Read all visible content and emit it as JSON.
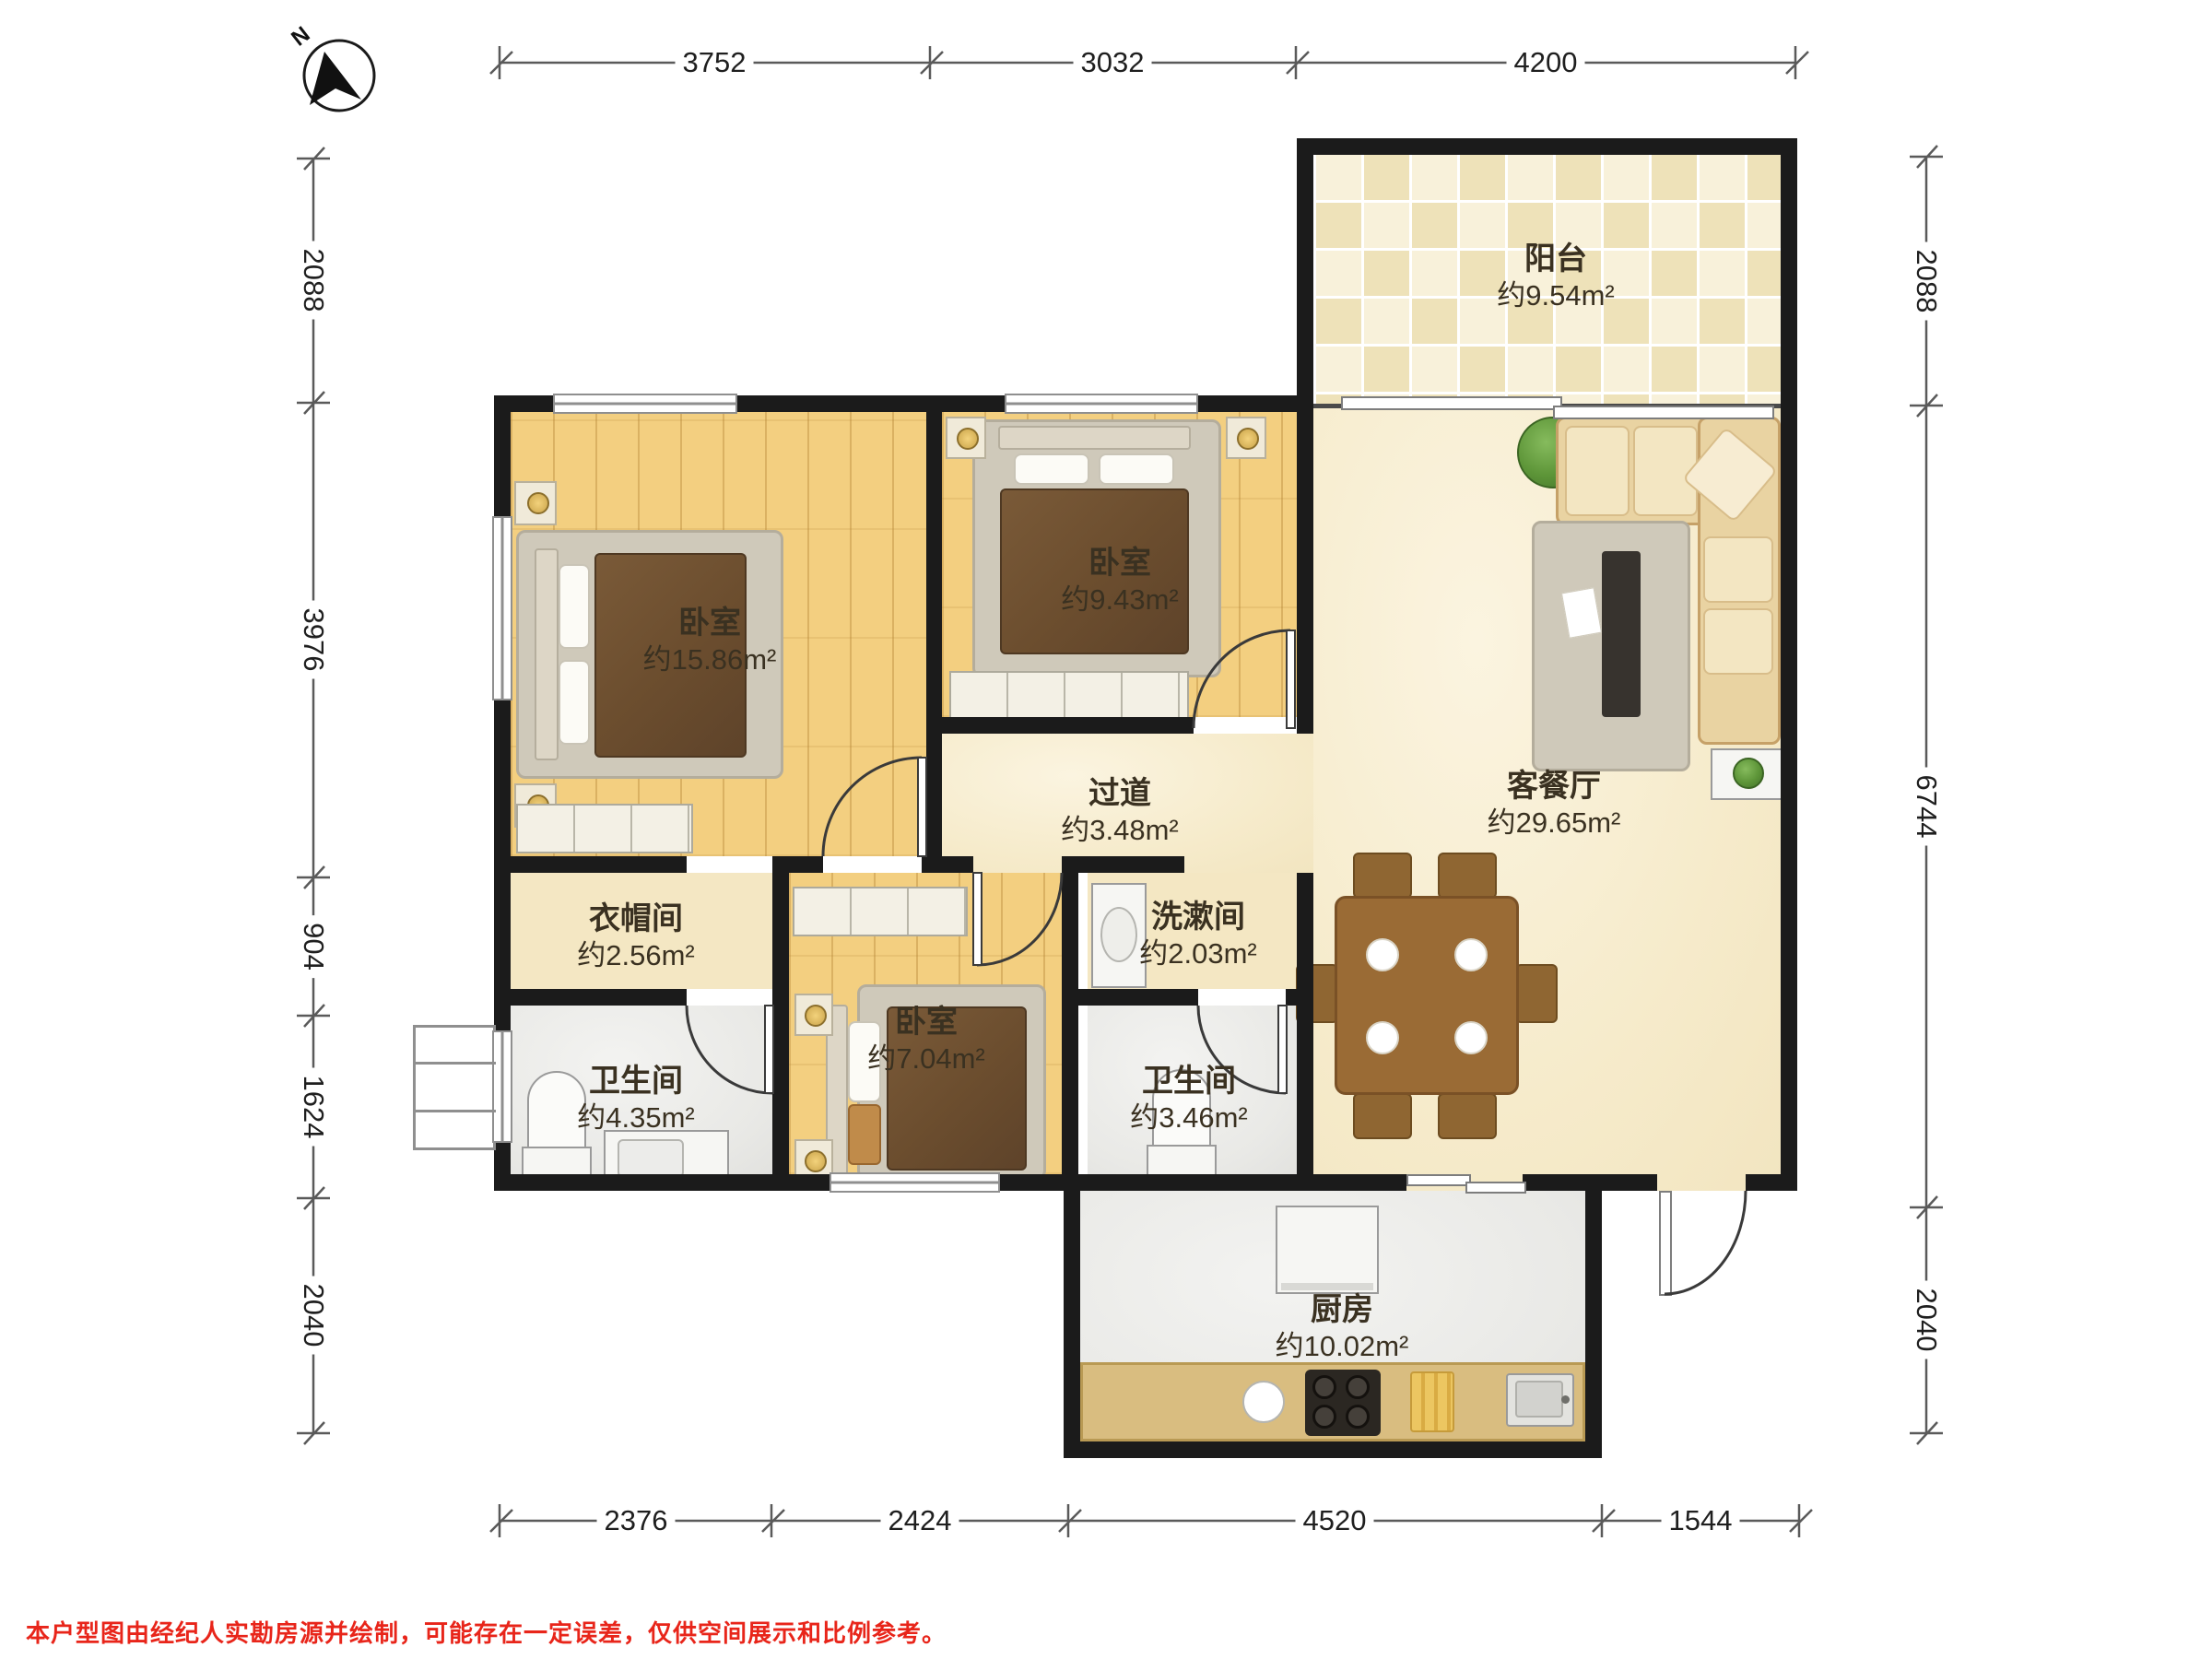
{
  "compass": {
    "label": "N"
  },
  "rooms": {
    "balcony": {
      "name": "阳台",
      "area": "约9.54m²"
    },
    "bedroom_master": {
      "name": "卧室",
      "area": "约15.86m²"
    },
    "bedroom_second": {
      "name": "卧室",
      "area": "约9.43m²"
    },
    "hallway": {
      "name": "过道",
      "area": "约3.48m²"
    },
    "living_dining": {
      "name": "客餐厅",
      "area": "约29.65m²"
    },
    "cloakroom": {
      "name": "衣帽间",
      "area": "约2.56m²"
    },
    "washroom": {
      "name": "洗漱间",
      "area": "约2.03m²"
    },
    "bedroom_small": {
      "name": "卧室",
      "area": "约7.04m²"
    },
    "bathroom_left": {
      "name": "卫生间",
      "area": "约4.35m²"
    },
    "bathroom_mid": {
      "name": "卫生间",
      "area": "约3.46m²"
    },
    "kitchen": {
      "name": "厨房",
      "area": "约10.02m²"
    }
  },
  "dimensions": {
    "top": [
      {
        "label": "3752"
      },
      {
        "label": "3032"
      },
      {
        "label": "4200"
      }
    ],
    "bottom": [
      {
        "label": "2376"
      },
      {
        "label": "2424"
      },
      {
        "label": "4520"
      },
      {
        "label": "1544"
      }
    ],
    "left": [
      {
        "label": "2088"
      },
      {
        "label": "3976"
      },
      {
        "label": "904"
      },
      {
        "label": "1624"
      },
      {
        "label": "2040"
      }
    ],
    "right": [
      {
        "label": "2088"
      },
      {
        "label": "6744"
      },
      {
        "label": "2040"
      }
    ]
  },
  "footer": {
    "disclaimer": "本户型图由经纪人实勘房源并绘制，可能存在一定误差，仅供空间展示和比例参考。"
  },
  "colors": {
    "wall": "#1b1b1b",
    "wood_floor": "#f3cf80",
    "marble_floor": "#f6ebcb",
    "tile_gray": "#e9e9e6",
    "balcony_tile": "#eee2b9",
    "disclaimer_red": "#e8251a"
  }
}
